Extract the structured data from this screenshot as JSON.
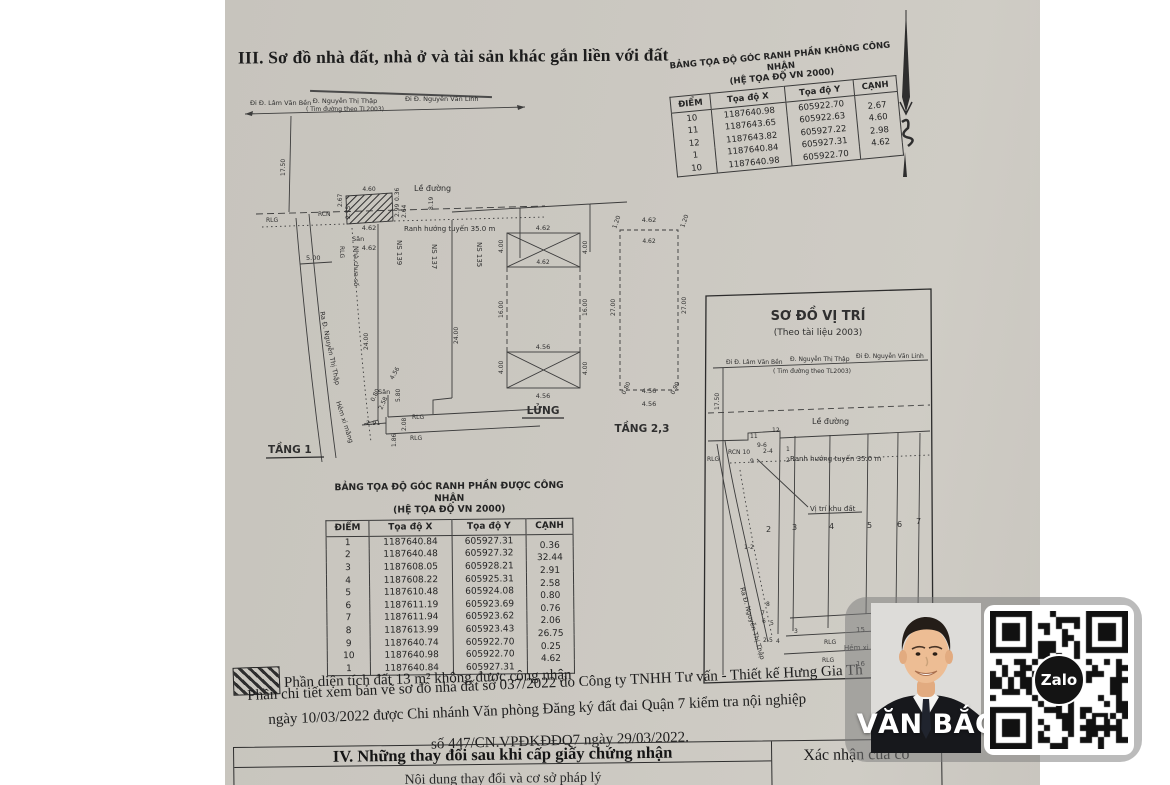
{
  "document": {
    "section3_title": "III. Sơ đồ nhà đất, nhà ở và tài sản khác gắn liền với đất",
    "legend_text": "Phần diện tích đất 13 m² không được công nhận",
    "note_line1": "Phần chi tiết xem bản vẽ sơ đồ nhà đất số 037/2022 do Công ty TNHH Tư vấn - Thiết kế Hưng Gia Th",
    "note_line2": "ngày 10/03/2022 được Chi nhánh Văn phòng Đăng ký đất đai Quận 7 kiểm tra nội nghiệp",
    "note_line3": "số 447/CN.VPĐKĐĐQ7 ngày 29/03/2022.",
    "section4_title": "IV. Những thay đổi sau khi cấp giấy chứng nhận",
    "section4_right_header": "Xác nhận của cơ",
    "section4_partial_row": "Nội dung thay đổi và cơ sở pháp lý"
  },
  "table_khong_cong_nhan": {
    "title_line1": "BẢNG TỌA ĐỘ GÓC RANH PHẦN KHÔNG CÔNG NHẬN",
    "title_line2": "(HỆ TỌA ĐỘ VN 2000)",
    "headers": [
      "ĐIỂM",
      "Tọa độ  X",
      "Tọa độ  Y",
      "CẠNH"
    ],
    "rows": [
      [
        "10",
        "1187640.98",
        "605922.70",
        "2.67"
      ],
      [
        "11",
        "1187643.65",
        "605922.63",
        "4.60"
      ],
      [
        "12",
        "1187643.82",
        "605927.22",
        "2.98"
      ],
      [
        "1",
        "1187640.84",
        "605927.31",
        "4.62"
      ],
      [
        "10",
        "1187640.98",
        "605922.70",
        ""
      ]
    ]
  },
  "table_duoc_cong_nhan": {
    "title_line1": "BẢNG TỌA ĐỘ GÓC RANH PHẦN ĐƯỢC CÔNG NHẬN",
    "title_line2": "(HỆ TỌA ĐỘ VN 2000)",
    "headers": [
      "ĐIỂM",
      "Tọa độ  X",
      "Tọa độ  Y",
      "CẠNH"
    ],
    "rows": [
      [
        "1",
        "1187640.84",
        "605927.31",
        "0.36"
      ],
      [
        "2",
        "1187640.48",
        "605927.32",
        "32.44"
      ],
      [
        "3",
        "1187608.05",
        "605928.21",
        "2.91"
      ],
      [
        "4",
        "1187608.22",
        "605925.31",
        "2.58"
      ],
      [
        "5",
        "1187610.48",
        "605924.08",
        "0.80"
      ],
      [
        "6",
        "1187611.19",
        "605923.69",
        "0.76"
      ],
      [
        "7",
        "1187611.94",
        "605923.62",
        "2.06"
      ],
      [
        "8",
        "1187613.99",
        "605923.43",
        "26.75"
      ],
      [
        "9",
        "1187640.74",
        "605922.70",
        "0.25"
      ],
      [
        "10",
        "1187640.98",
        "605922.70",
        "4.62"
      ],
      [
        "1",
        "1187640.84",
        "605927.31",
        ""
      ]
    ]
  },
  "plan": {
    "streets": {
      "left": "Đi Đ. Lâm Văn Bền",
      "center": "Đ. Nguyễn Thị Thập",
      "center_sub": "( Tim đường theo TL2003)",
      "right": "Đi Đ. Nguyễn Văn Linh"
    },
    "tang1": {
      "label": "TẦNG 1",
      "d1750": "17.50",
      "le_duong": "Lề đường",
      "rlg_left": "RLG",
      "rcn": "RCN",
      "ranh": "Ranh hướng tuyến 35.0 m",
      "d460": "4.60",
      "d267": "2.67",
      "d275": "2.75",
      "d036": "0.36",
      "d299": "2.99",
      "d264": "2.64",
      "d819": "8.19",
      "d462a": "4.62",
      "san_top": "Sân",
      "d462b": "4.62",
      "d500": "5.00",
      "rlg_mid": "RLG",
      "nha_chua_so": "Nhà chưa số",
      "ra_duong": "Ra Đ. Nguyễn Thị Thập",
      "ns139": "NS 139",
      "ns137": "NS 137",
      "ns135": "NS 135",
      "d2400a": "24.00",
      "d2400b": "24.00",
      "hem": "Hẻm xi măng",
      "d456": "4.56",
      "san_bot": "Sân",
      "d580": "5.80",
      "d080": "0.80",
      "d258": "2.58",
      "d291": "2.91",
      "d186": "1.86",
      "d208": "2.08",
      "rlg_b1": "RLG",
      "rlg_b2": "RLG"
    },
    "lung": {
      "label": "LỬNG",
      "w_top": "4.62",
      "h_tl": "4.00",
      "h_tr": "4.00",
      "w_top_in": "4.62",
      "s_l": "16.00",
      "s_r": "16.00",
      "w_bot": "4.56",
      "h_bl": "4.00",
      "h_br": "4.00",
      "w_bot_in": "4.56"
    },
    "tang23": {
      "label": "TẦNG 2,3",
      "w_top": "4.62",
      "c_tl": "1.20",
      "c_tr": "1.20",
      "w_top_in": "4.62",
      "s_l": "27.00",
      "s_r": "27.00",
      "c_bl": "0.80",
      "w_bot": "4.56",
      "c_br": "0.90",
      "w_bot_in": "4.56"
    }
  },
  "vitri": {
    "title": "SƠ ĐỒ VỊ TRÍ",
    "subtitle": "(Theo tài liệu 2003)",
    "street_left": "Đi Đ. Lâm Văn Bền",
    "street_center": "Đ. Nguyễn Thị Thập",
    "street_right": "Đi Đ. Nguyễn Văn Linh",
    "street_sub": "( Tim đường theo TL2003)",
    "d1750": "17.50",
    "le_duong": "Lề đường",
    "p11": "11",
    "p12": "12",
    "p96": "9-6",
    "rcn10": "RCN 10",
    "p24": "2-4",
    "p1": "1",
    "rlg_l": "RLG",
    "p9": "9",
    "p2": "2",
    "ranh": "Ranh hướng tuyến 35.0 m",
    "vi_tri_label": "Vị trí khu đất",
    "lots": [
      "2",
      "3",
      "4",
      "5",
      "6",
      "7"
    ],
    "p1_2": "1-2",
    "ra_duong": "Ra Đ. Nguyễn Thị Thập",
    "p8": "8",
    "p7": "7",
    "p6": "6",
    "p5": "5",
    "p3": "3",
    "p2_5": "2-5",
    "p4": "4",
    "lot15": "15",
    "hem": "Hẻm xi măng",
    "rlg_m": "RLG",
    "lot16": "16",
    "rlg_b": "RLG"
  },
  "overlay": {
    "name": "VĂN BẮC",
    "zalo_label": "Zalo"
  }
}
